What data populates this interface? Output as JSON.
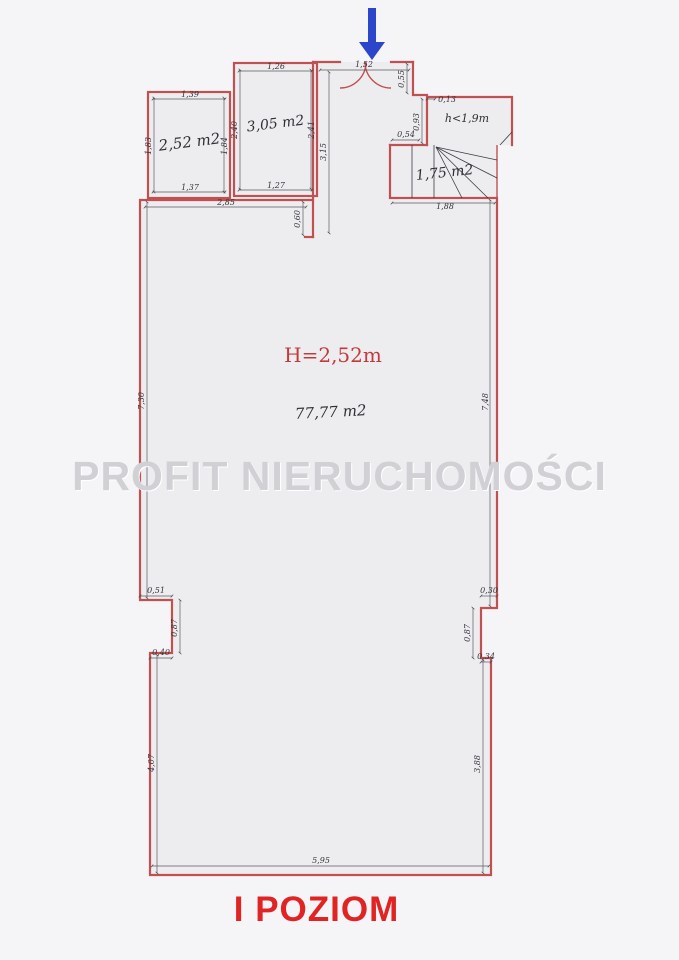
{
  "title": "I POZIOM",
  "watermark": "PROFIT NIERUCHOMOŚCI",
  "main_room": {
    "height_label": "H=2,52m",
    "area": "77,77 m2",
    "dims": {
      "top": "2,85",
      "left": "7,30",
      "right": "7,48",
      "bottom": "5,95",
      "bottom_left": "4,07",
      "bottom_right": "3,88",
      "stub": "0,60",
      "notch_left": {
        "w": "0,51",
        "h": "0,87",
        "w2": "0,40"
      },
      "notch_right": {
        "w": "0,30",
        "h": "0,87",
        "w2": "0,34"
      }
    }
  },
  "room1": {
    "area": "2,52 m2",
    "dims": {
      "top": "1,39",
      "bottom": "1,37",
      "left": "1,83",
      "right": "1,84"
    }
  },
  "room2": {
    "area": "3,05 m2",
    "dims": {
      "top": "1,26",
      "bottom": "1,27",
      "left": "2,40",
      "right": "2,41"
    }
  },
  "entrance": {
    "dims": {
      "width": "1,52",
      "side": "0,55",
      "corridor": "3,15"
    }
  },
  "attic": {
    "label": "h<1,9m",
    "dims": {
      "offset": "0,13",
      "left": "0,93"
    }
  },
  "stairs": {
    "area": "1,75 m2",
    "dims": {
      "top": "0,54",
      "bottom": "1,88"
    }
  },
  "colors": {
    "wall": "#c15050",
    "dimension": "#34343c",
    "title_red": "#e02424",
    "label_red": "#c23b3b",
    "arrow_blue": "#2b46c8",
    "watermark_gray": "#d0d0d5"
  }
}
